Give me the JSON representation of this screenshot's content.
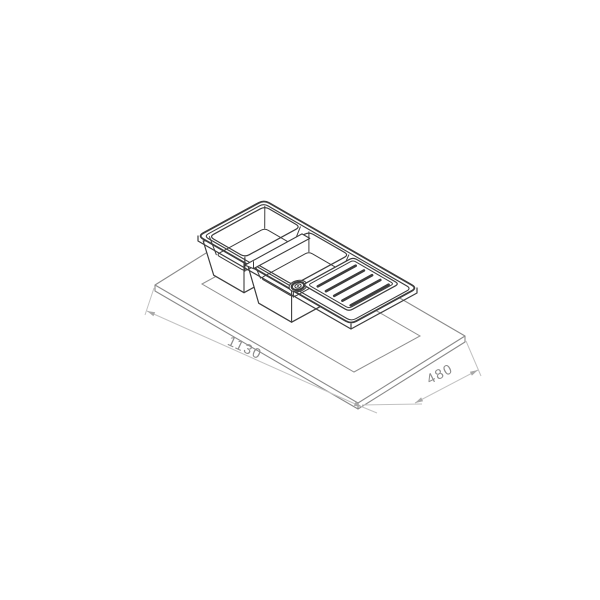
{
  "diagram": {
    "type": "isometric technical line drawing",
    "subject": "inset kitchen sink with one-and-a-half bowls and ribbed drainer, shown raised above a worktop with sink cutout",
    "dimensions": {
      "length": {
        "label": "1130"
      },
      "depth": {
        "label": "480"
      }
    },
    "drainer_groove_count": 5,
    "colors": {
      "background": "#ffffff",
      "sink_line": "#3d3d3d",
      "counter_line": "#8a8a8a",
      "dimension_line": "#c2c2c2",
      "dimension_arrow": "#a8a8a8",
      "dimension_text": "#8c8c8c"
    }
  }
}
